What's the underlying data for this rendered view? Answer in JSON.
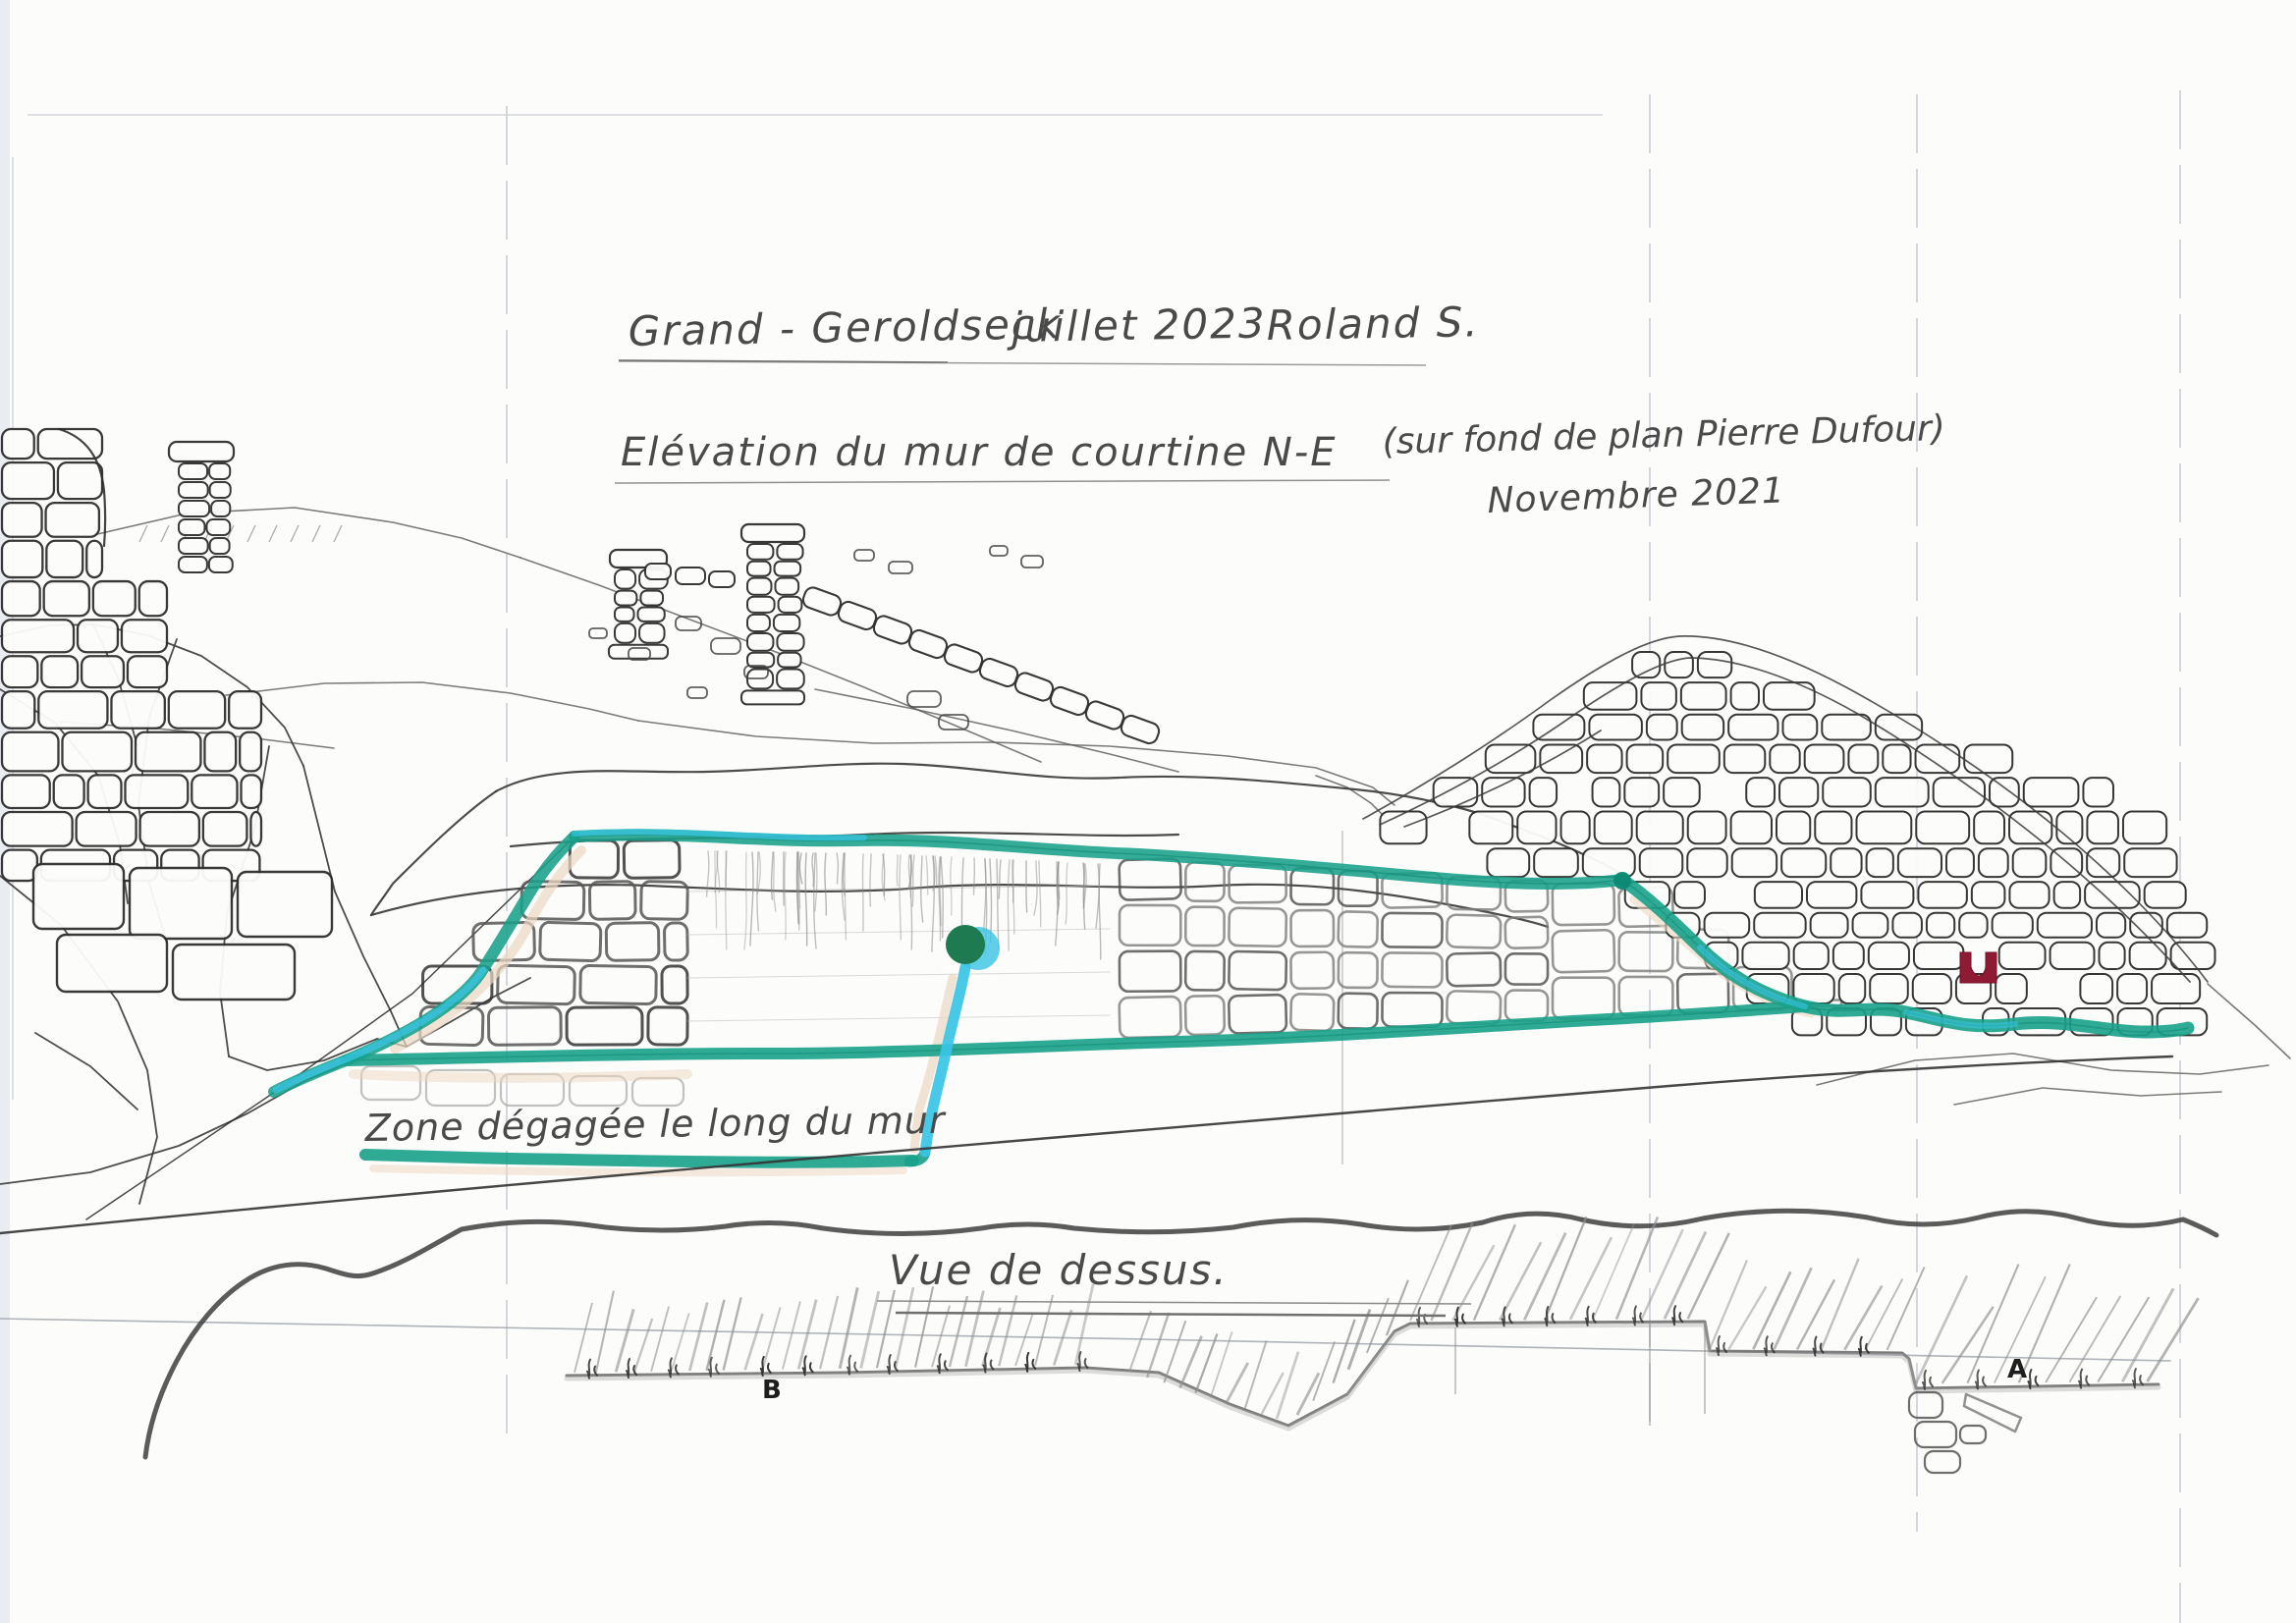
{
  "titles": {
    "site": "Grand - Geroldseck",
    "survey_date": "juillet 2023",
    "author": "Roland S.",
    "subtitle": "Elévation du mur de courtine N-E",
    "subtitle_note": "(sur fond de plan Pierre Dufour)",
    "plan_date": "Novembre 2021"
  },
  "annotations": {
    "zone": "Zone dégagée le long du mur",
    "bottom_caption": "Vue de dessus.",
    "point_a": "A",
    "point_b": "B"
  },
  "colors": {
    "paper": "#fcfcfa",
    "pencil": "#6b6b6b",
    "ink": "#2f2f2f",
    "teal_marker": "#18a18a",
    "cyan_marker": "#38c4e6",
    "dot_green": "#1e7b51",
    "opening_red": "#8e1b33",
    "fold_line": "#b9c0cc",
    "shadow_tan": "#ecd8c2"
  }
}
